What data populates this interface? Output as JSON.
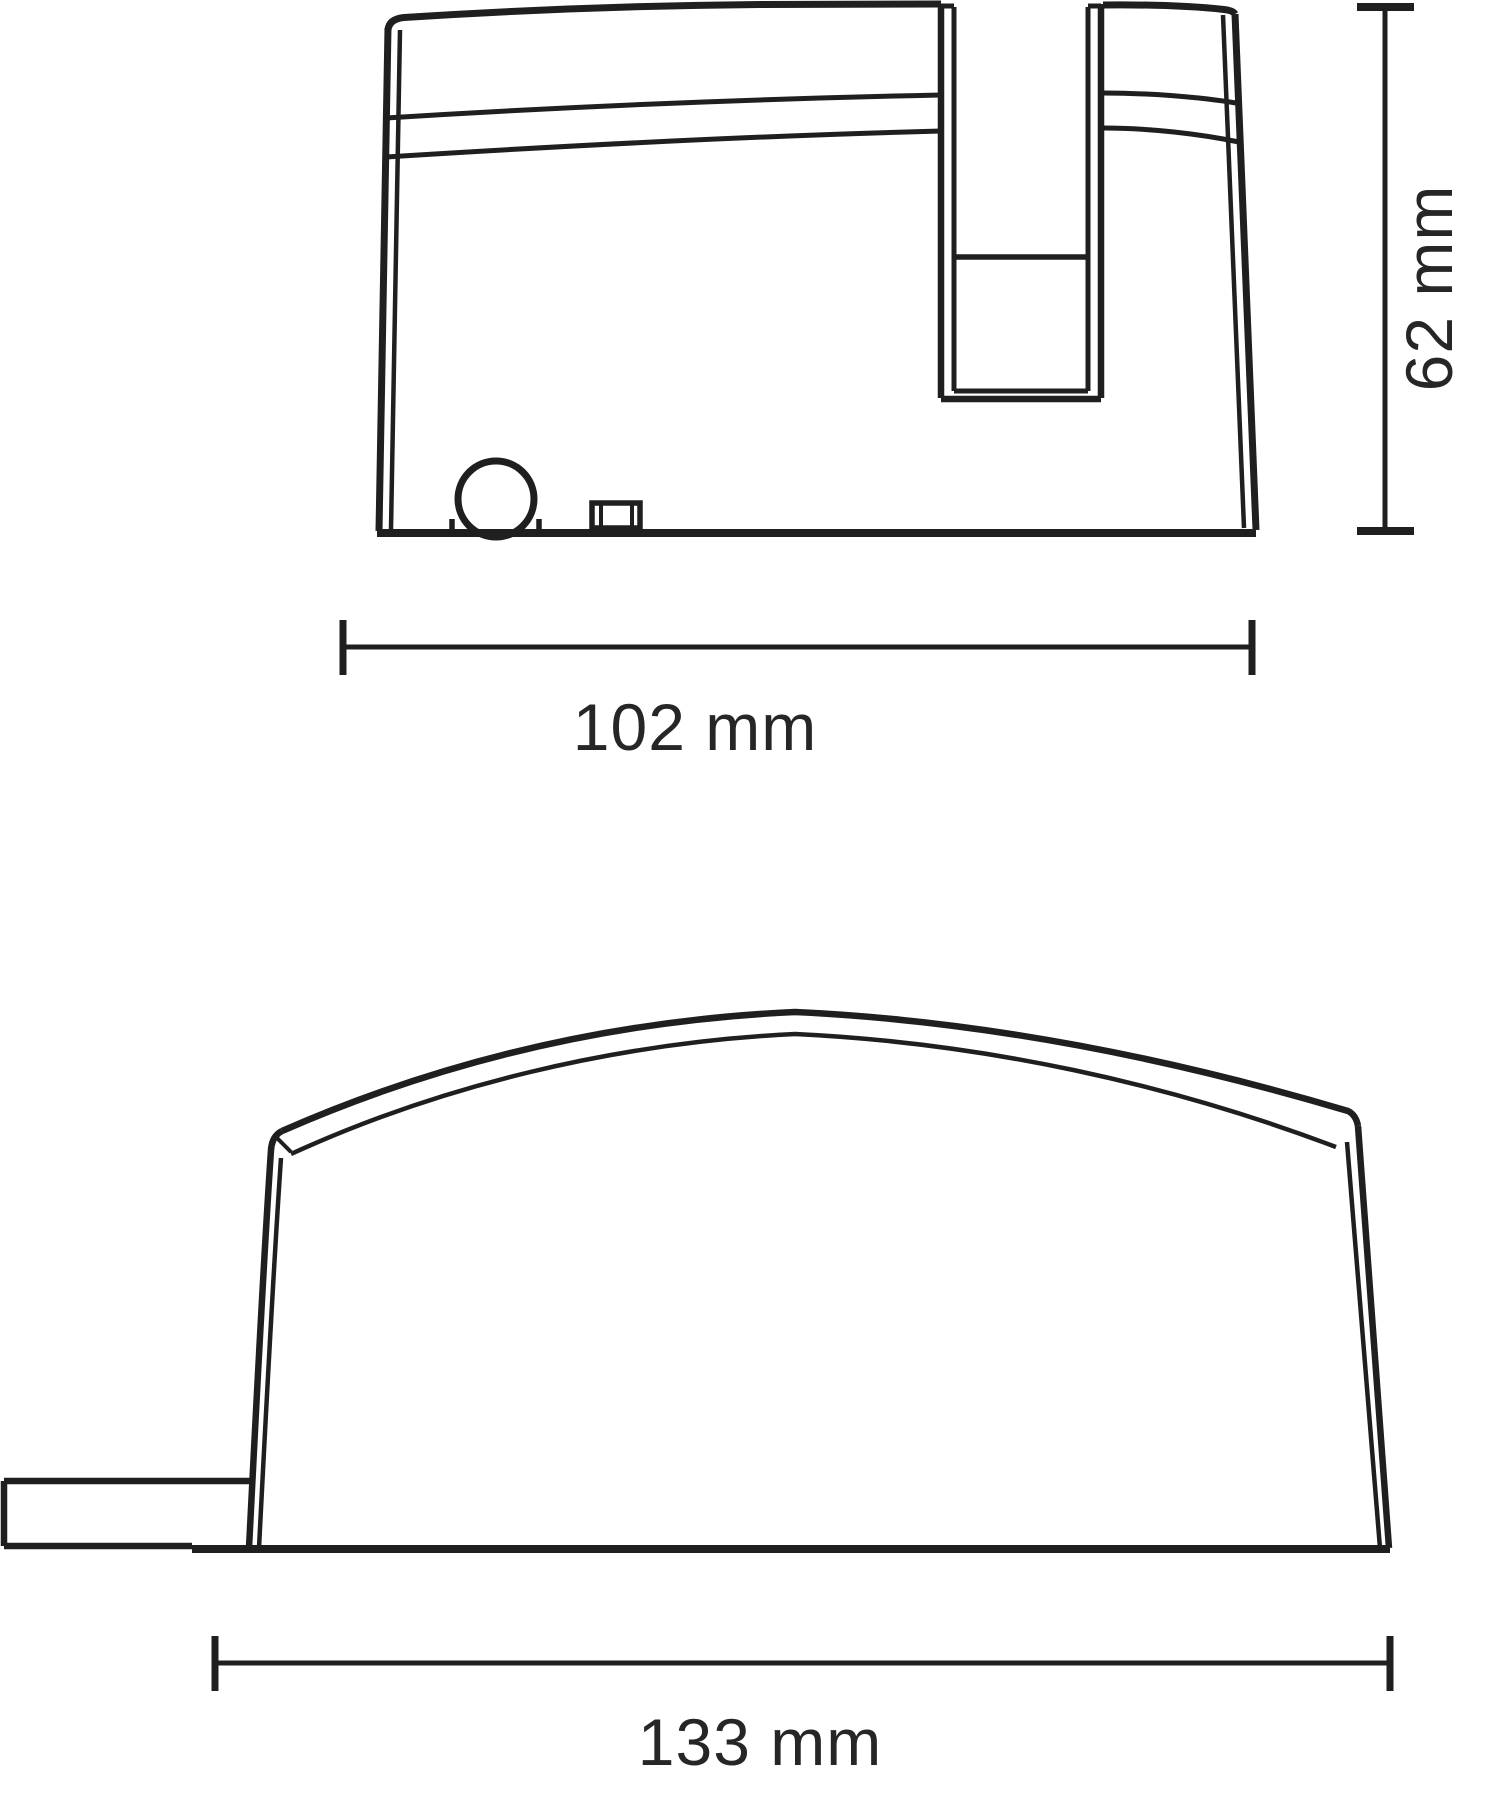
{
  "page": {
    "background": "#ffffff",
    "description": "Technical dimension drawing with two orthographic views of a plastic housing"
  },
  "drawing": {
    "kind": "product-dimension-line-drawing",
    "views": [
      {
        "name": "side-view",
        "features": [
          "arched top edge",
          "two seam lines",
          "U-shaped slot",
          "cable hole circle",
          "small clip slot"
        ],
        "dimensions": [
          {
            "axis": "width",
            "label": "102 mm",
            "value": 102,
            "unit": "mm"
          },
          {
            "axis": "height",
            "label": "62 mm",
            "value": 62,
            "unit": "mm"
          }
        ]
      },
      {
        "name": "front-view",
        "features": [
          "domed cover outline",
          "inner seam arc",
          "cable tab on left side"
        ],
        "dimensions": [
          {
            "axis": "width",
            "label": "133 mm",
            "value": 133,
            "unit": "mm"
          }
        ]
      }
    ]
  },
  "labels": {
    "side_width": "102 mm",
    "side_height": "62 mm",
    "front_width": "133 mm"
  },
  "colors": {
    "line": "#1f1f1f",
    "text": "#262626",
    "background": "#ffffff"
  }
}
